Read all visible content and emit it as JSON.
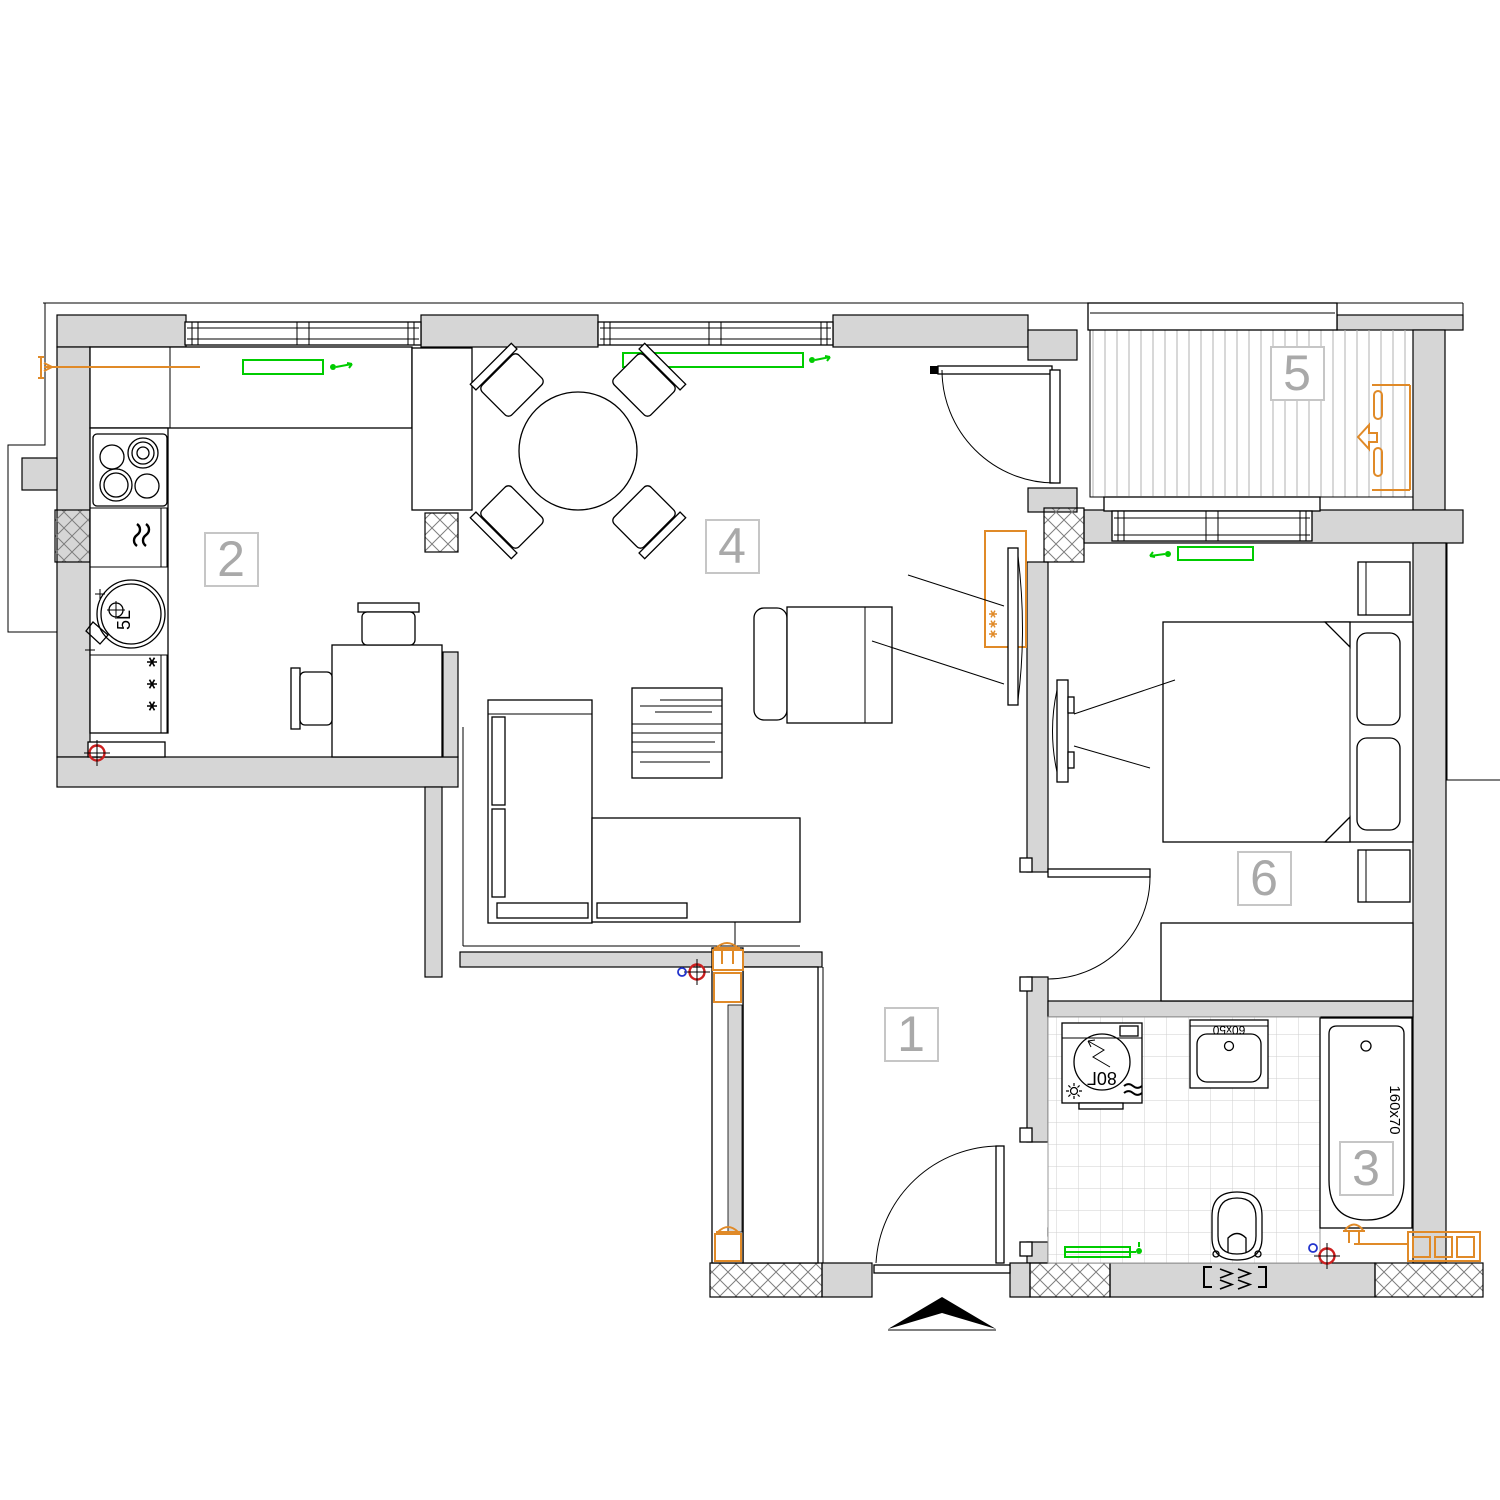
{
  "plan": {
    "type": "apartment-floor-plan",
    "rooms": [
      {
        "number": "1"
      },
      {
        "number": "2"
      },
      {
        "number": "3"
      },
      {
        "number": "4"
      },
      {
        "number": "5"
      },
      {
        "number": "6"
      }
    ],
    "labels": {
      "bathtub_size": "160x70",
      "washbasin_size": "60x50",
      "boiler_capacity": "80Г",
      "kitchen_sink_capacity": "5L"
    },
    "colors": {
      "wall_fill": "#d6d6d6",
      "line": "#000000",
      "light_fixture_green": "#00cc00",
      "utility_orange": "#e08a28",
      "drain_red": "#cc2020",
      "sensor_blue": "#2233cc",
      "room_label_gray": "#a9a9a9"
    }
  }
}
